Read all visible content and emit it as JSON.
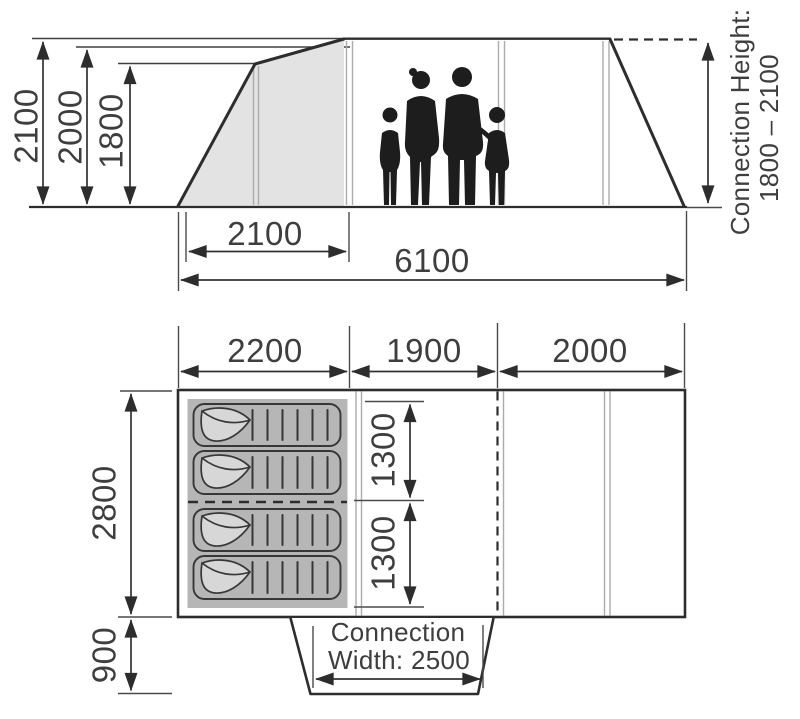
{
  "diagram_type": "tent-dimension-diagram",
  "side_view": {
    "heights": [
      "2100",
      "2000",
      "1800"
    ],
    "porch_width": "2100",
    "total_length": "6100",
    "connection_height": {
      "line1": "Connection Height:",
      "line2": "1800 – 2100"
    }
  },
  "floor_plan": {
    "top_widths": [
      "2200",
      "1900",
      "2000"
    ],
    "inner_depth": "2800",
    "canopy_depth": "900",
    "beds": [
      "1300",
      "1300"
    ],
    "connection": {
      "line1": "Connection",
      "line2": "Width: 2500"
    }
  },
  "colors": {
    "line": "#2d2d2d",
    "dim_text": "#3e3e3e",
    "porch_fill": "#e3e3e3",
    "sleeping_area_fill": "#b6b6b6",
    "mat_flap_fill": "#d7d7d7",
    "silhouette": "#1d1d1d",
    "background": "#ffffff"
  }
}
